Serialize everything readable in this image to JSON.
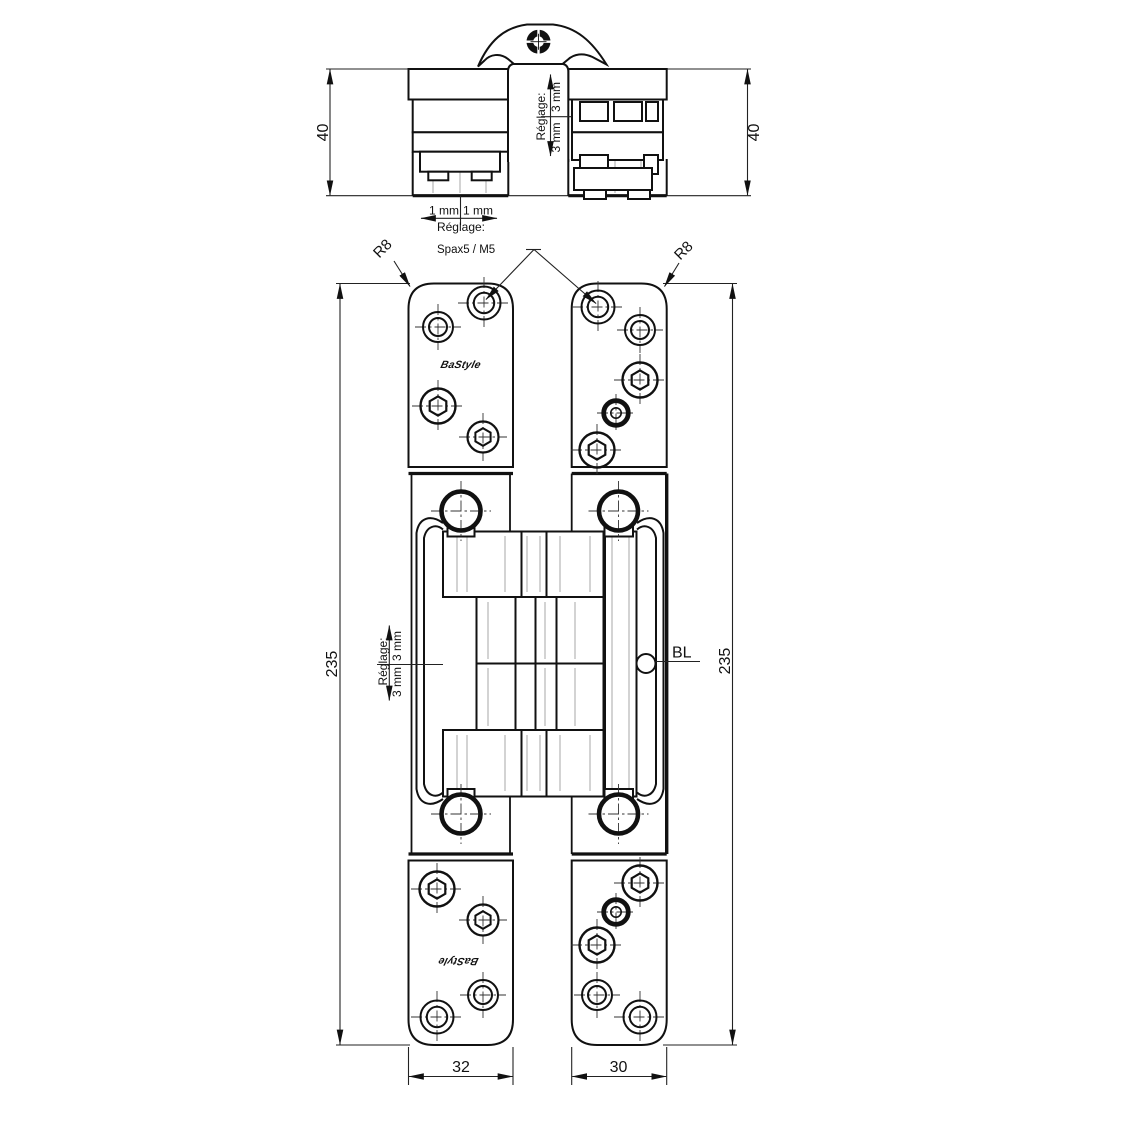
{
  "drawing": {
    "line_color": "#111111",
    "light_line_color": "#c8c8c8",
    "background": "#ffffff",
    "top_view": {
      "dim_left": "40",
      "dim_right": "40",
      "vertical_adjust": {
        "label": "Réglage:",
        "upper": "3 mm",
        "lower": "3 mm"
      },
      "horizontal_adjust": {
        "label": "Réglage:",
        "left": "1 mm",
        "right": "1 mm"
      }
    },
    "front_view": {
      "corner_radius_left": "R8",
      "corner_radius_right": "R8",
      "screw_spec": "Spax5 / M5",
      "height_left": "235",
      "height_right": "235",
      "vertical_adjust": {
        "label": "Réglage:",
        "upper": "3 mm",
        "lower": "3 mm"
      },
      "axis_label": "BL",
      "width_left": "32",
      "width_right": "30",
      "brand_logo_top": "BaStyle",
      "brand_logo_bottom": "BaStyle"
    }
  }
}
